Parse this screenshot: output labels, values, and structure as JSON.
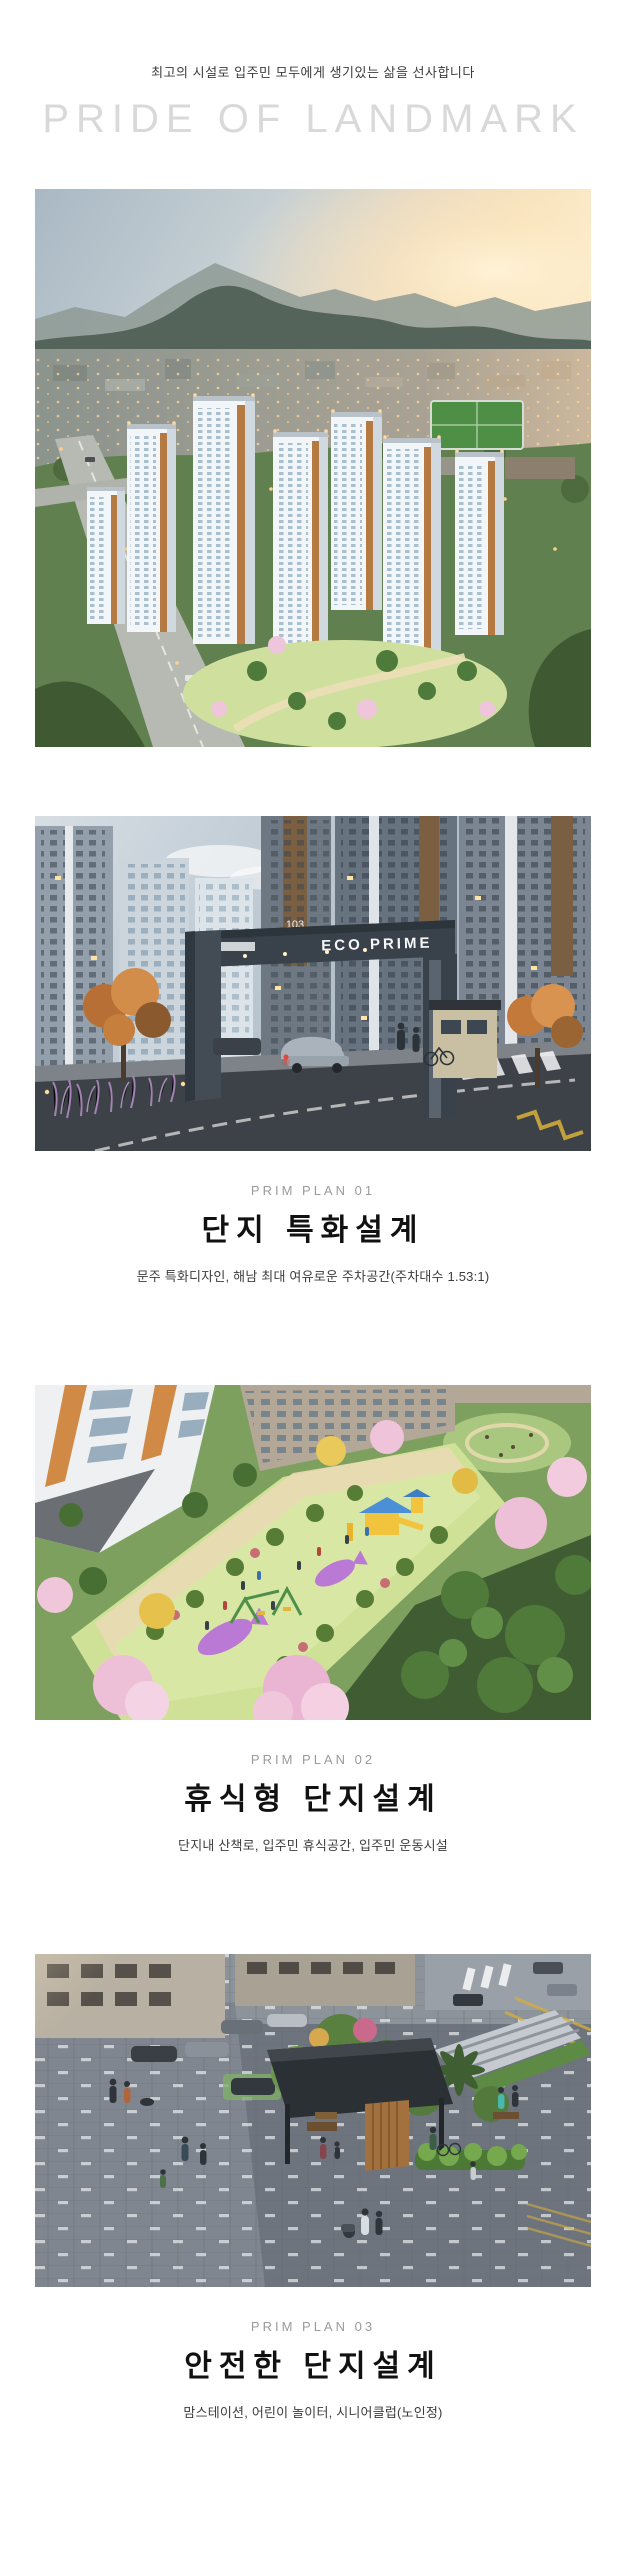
{
  "header": {
    "tagline": "최고의 시설로 입주민 모두에게 생기있는 삶을 선사합니다",
    "headline": "PRIDE OF LANDMARK"
  },
  "images": {
    "gate": {
      "sign_text": "ECO PRIME",
      "tower_number": "103"
    }
  },
  "sections": [
    {
      "label": "PRIM PLAN 01",
      "title": "단지 특화설계",
      "desc": "문주 특화디자인, 해남 최대 여유로운 주차공간(주차대수 1.53:1)"
    },
    {
      "label": "PRIM PLAN 02",
      "title": "휴식형 단지설계",
      "desc": "단지내 산책로, 입주민 휴식공간, 입주민 운동시설"
    },
    {
      "label": "PRIM PLAN 03",
      "title": "안전한 단지설계",
      "desc": "맘스테이션, 어린이 놀이터, 시니어클럽(노인정)"
    }
  ],
  "colors": {
    "headline": "#d9d9d9",
    "plan_label": "#9b9b9b",
    "plan_title": "#111111",
    "plan_desc": "#3d3d3d"
  }
}
